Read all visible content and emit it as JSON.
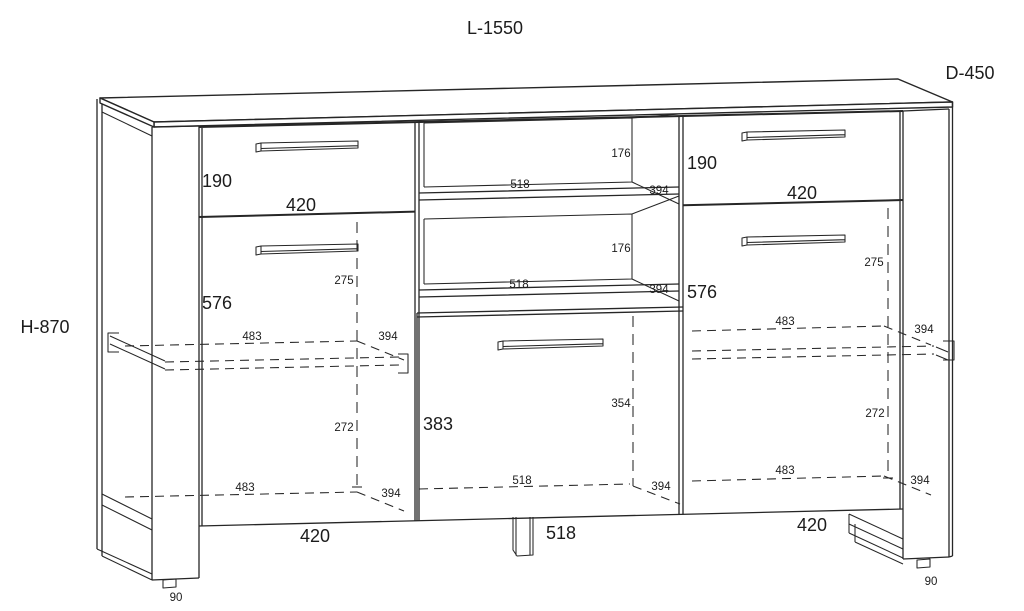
{
  "overall": {
    "length_label": "L-1550",
    "depth_label": "D-450",
    "height_label": "H-870"
  },
  "left_section": {
    "drawer_height": "190",
    "drawer_width": "420",
    "door_height": "576",
    "handle_offset": "275",
    "shelf_width": "483",
    "shelf_depth": "394",
    "shelf_gap": "272",
    "bottom_width": "483",
    "bottom_depth": "394",
    "section_width": "420",
    "leg_height": "90"
  },
  "middle_section": {
    "niche1_height": "176",
    "niche1_width": "518",
    "niche1_depth": "394",
    "niche2_height": "176",
    "niche2_width": "518",
    "niche2_depth": "394",
    "drawer_height": "383",
    "inner_height": "354",
    "inner_width": "518",
    "inner_depth": "394",
    "section_width": "518"
  },
  "right_section": {
    "drawer_height": "190",
    "drawer_width": "420",
    "door_height": "576",
    "handle_offset": "275",
    "shelf_width": "483",
    "shelf_depth": "394",
    "shelf_gap": "272",
    "bottom_width": "483",
    "bottom_depth": "394",
    "section_width": "420",
    "leg_height": "90"
  }
}
